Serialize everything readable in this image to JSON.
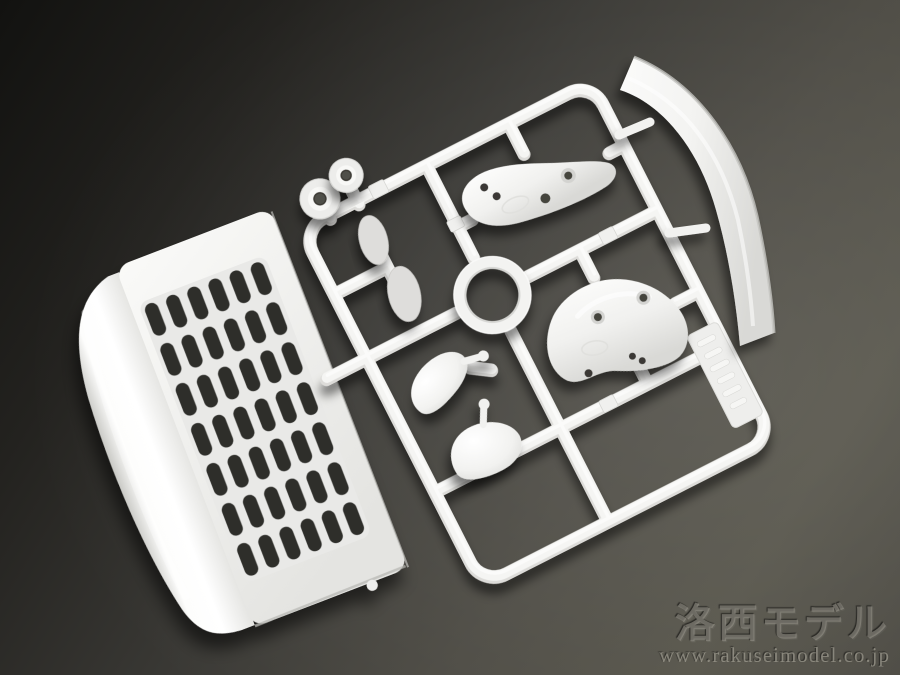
{
  "photo": {
    "subject": "White plastic model-kit parts sprue (injection-molded runner) photographed on a dark gray background",
    "parts": [
      {
        "name": "front-grille-panel"
      },
      {
        "name": "roof-deflector-blade"
      },
      {
        "name": "mirror-stay-bracket-upper"
      },
      {
        "name": "mirror-stay-bracket-lower"
      },
      {
        "name": "mirror-housing-upper"
      },
      {
        "name": "mirror-housing-lower"
      },
      {
        "name": "mirror-face-small"
      },
      {
        "name": "mirror-face-large"
      },
      {
        "name": "round-cap-small"
      },
      {
        "name": "round-cap-large"
      },
      {
        "name": "ring-grommet"
      },
      {
        "name": "molded-id-tag"
      }
    ],
    "colors": {
      "background_dark": "#1b1b19",
      "background_light": "#56544b",
      "plastic_white": "#f4f4f2",
      "plastic_shadow": "#c9c9c6",
      "slot_dark": "#2e2e2a"
    }
  },
  "watermark": {
    "brand": "洛西モデル",
    "url": "www.rakuseimodel.co.jp"
  }
}
